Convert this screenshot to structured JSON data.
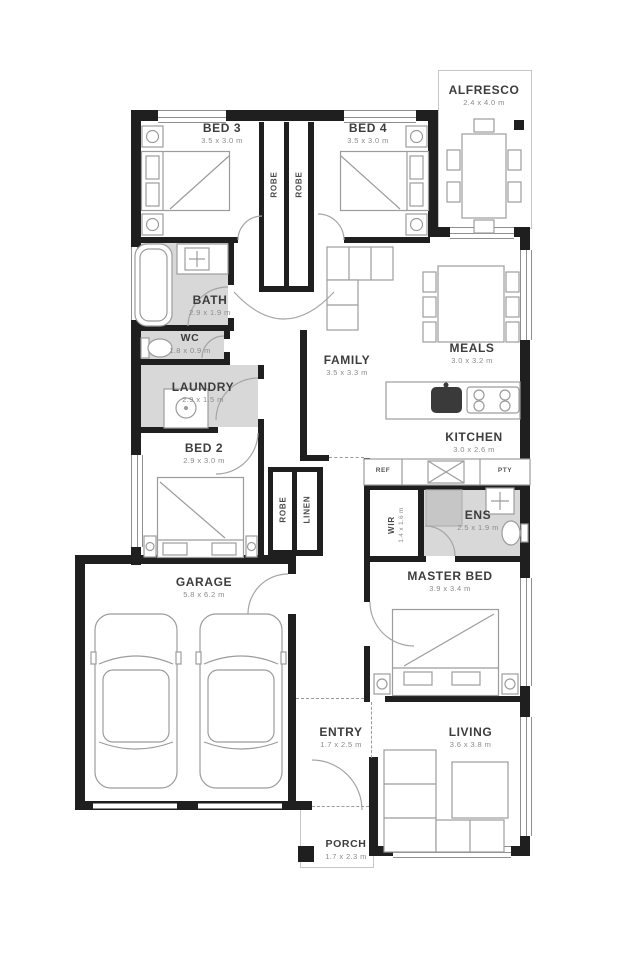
{
  "plan": {
    "colors": {
      "wall": "#1f1f1f",
      "wet": "#d8d8d8",
      "line": "#9c9c9c",
      "label": "#3d3d3d",
      "dims": "#8b8b8b",
      "bg": "#ffffff"
    },
    "rooms": [
      {
        "id": "bed3",
        "label": "BED 3",
        "dims": "3.5 x 3.0 m"
      },
      {
        "id": "bed4",
        "label": "BED 4",
        "dims": "3.5 x 3.0 m"
      },
      {
        "id": "alfresco",
        "label": "ALFRESCO",
        "dims": "2.4 x 4.0 m"
      },
      {
        "id": "bath",
        "label": "BATH",
        "dims": "2.9 x 1.9 m"
      },
      {
        "id": "wc",
        "label": "WC",
        "dims": "1.8 x 0.9 m"
      },
      {
        "id": "laundry",
        "label": "LAUNDRY",
        "dims": "2.9 x 1.5 m"
      },
      {
        "id": "family",
        "label": "FAMILY",
        "dims": "3.5 x 3.3 m"
      },
      {
        "id": "meals",
        "label": "MEALS",
        "dims": "3.0 x 3.2 m"
      },
      {
        "id": "kitchen",
        "label": "KITCHEN",
        "dims": "3.0 x 2.6 m"
      },
      {
        "id": "bed2",
        "label": "BED 2",
        "dims": "2.9 x 3.0 m"
      },
      {
        "id": "wir",
        "label": "WIR",
        "dims": "1.4 x 1.6 m"
      },
      {
        "id": "ens",
        "label": "ENS",
        "dims": "2.5 x 1.9 m"
      },
      {
        "id": "master",
        "label": "MASTER BED",
        "dims": "3.9 x 3.4 m"
      },
      {
        "id": "garage",
        "label": "GARAGE",
        "dims": "5.8 x 6.2 m"
      },
      {
        "id": "entry",
        "label": "ENTRY",
        "dims": "1.7 x 2.5 m"
      },
      {
        "id": "living",
        "label": "LIVING",
        "dims": "3.6 x 3.8 m"
      },
      {
        "id": "porch",
        "label": "PORCH",
        "dims": "1.7 x 2.3 m"
      }
    ],
    "closets": {
      "robe_bed3": "ROBE",
      "robe_bed4": "ROBE",
      "robe_bed2": "ROBE",
      "linen": "LINEN"
    },
    "appliances": {
      "fridge": "REF",
      "pantry": "PTY"
    }
  }
}
